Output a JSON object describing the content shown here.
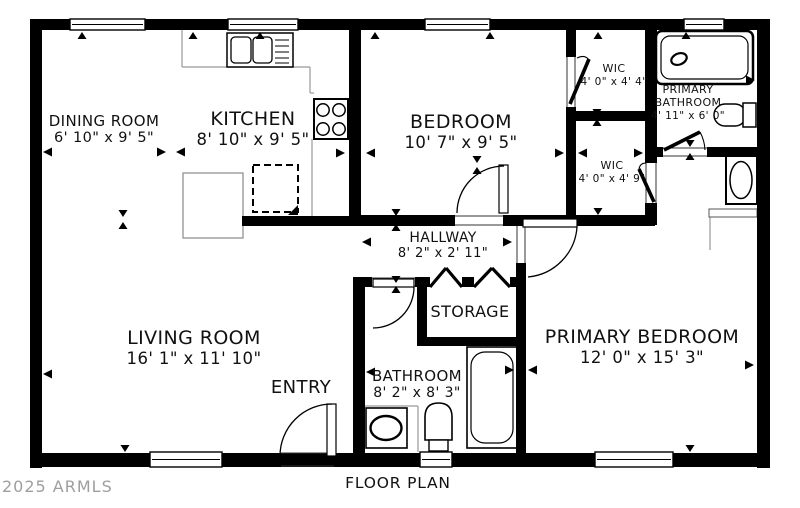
{
  "caption": "FLOOR PLAN",
  "watermark": "2025 ARMLS",
  "colors": {
    "wall": "#000000",
    "counter": "#999999",
    "jamb": "#333333",
    "text": "#111111",
    "watermark": "#9e9e9e",
    "bg": "#ffffff"
  },
  "rooms": [
    {
      "n": "dining-room",
      "lines": [
        "DINING ROOM",
        "6' 10\" x 9' 5\""
      ],
      "x": 104,
      "y": 113,
      "fs": [
        15,
        14.5
      ]
    },
    {
      "n": "kitchen",
      "lines": [
        "KITCHEN",
        "8' 10\" x 9' 5\""
      ],
      "x": 253,
      "y": 108,
      "fs": [
        19,
        16.5
      ]
    },
    {
      "n": "bedroom",
      "lines": [
        "BEDROOM",
        "10' 7\" x 9' 5\""
      ],
      "x": 461,
      "y": 111,
      "fs": [
        19,
        16.5
      ]
    },
    {
      "n": "wic-top",
      "lines": [
        "WIC",
        "4' 0\" x 4' 4\""
      ],
      "x": 614,
      "y": 63,
      "fs": [
        11,
        10.5
      ]
    },
    {
      "n": "primary-bathroom",
      "lines": [
        "PRIMARY",
        "BATHROOM",
        "4' 11\" x 6' 0\""
      ],
      "x": 688,
      "y": 84,
      "fs": [
        11,
        11,
        10.5
      ]
    },
    {
      "n": "wic-bottom",
      "lines": [
        "WIC",
        "4' 0\" x 4' 9\""
      ],
      "x": 612,
      "y": 160,
      "fs": [
        11,
        10.5
      ]
    },
    {
      "n": "hallway",
      "lines": [
        "HALLWAY",
        "8' 2\" x 2' 11\""
      ],
      "x": 443,
      "y": 230,
      "fs": [
        14,
        13
      ]
    },
    {
      "n": "storage",
      "lines": [
        "STORAGE"
      ],
      "x": 470,
      "y": 303,
      "fs": [
        16
      ]
    },
    {
      "n": "living-room",
      "lines": [
        "LIVING ROOM",
        "16' 1\" x 11' 10\""
      ],
      "x": 194,
      "y": 327,
      "fs": [
        19,
        16.5
      ]
    },
    {
      "n": "entry",
      "lines": [
        "ENTRY"
      ],
      "x": 301,
      "y": 378,
      "fs": [
        18
      ]
    },
    {
      "n": "bathroom",
      "lines": [
        "BATHROOM",
        "8' 2\" x 8' 3\""
      ],
      "x": 417,
      "y": 368,
      "fs": [
        15,
        14
      ]
    },
    {
      "n": "primary-bedroom",
      "lines": [
        "PRIMARY BEDROOM",
        "12' 0\" x 15' 3\""
      ],
      "x": 642,
      "y": 326,
      "fs": [
        19,
        16.5
      ]
    }
  ],
  "caption_pos": {
    "x": 398,
    "y": 474
  },
  "watermark_pos": {
    "x": 2,
    "y": 477
  },
  "plan": {
    "walls": [
      [
        30,
        19,
        740,
        11
      ],
      [
        30,
        19,
        12,
        449
      ],
      [
        30,
        453,
        740,
        14
      ],
      [
        757,
        19,
        13,
        449
      ],
      [
        349,
        30,
        12,
        196
      ],
      [
        242,
        216,
        119,
        10
      ],
      [
        361,
        215,
        94,
        11
      ],
      [
        503,
        215,
        152,
        11
      ],
      [
        566,
        30,
        10,
        27
      ],
      [
        566,
        107,
        10,
        108
      ],
      [
        566,
        111,
        91,
        10
      ],
      [
        645,
        30,
        12,
        133
      ],
      [
        645,
        203,
        12,
        22
      ],
      [
        645,
        147,
        18,
        10
      ],
      [
        707,
        147,
        63,
        10
      ],
      [
        353,
        277,
        19,
        10
      ],
      [
        415,
        277,
        15,
        10
      ],
      [
        462,
        277,
        12,
        10
      ],
      [
        510,
        277,
        16,
        10
      ],
      [
        353,
        277,
        12,
        190
      ],
      [
        417,
        287,
        10,
        59
      ],
      [
        417,
        337,
        109,
        9
      ],
      [
        516,
        287,
        10,
        50
      ],
      [
        516,
        263,
        10,
        24
      ],
      [
        516,
        346,
        10,
        107
      ]
    ],
    "windows": [
      [
        70,
        19,
        75,
        11
      ],
      [
        228,
        19,
        70,
        11
      ],
      [
        425,
        19,
        65,
        11
      ],
      [
        684,
        19,
        40,
        11
      ],
      [
        150,
        452,
        72,
        15
      ],
      [
        420,
        452,
        32,
        15
      ],
      [
        595,
        452,
        78,
        15
      ]
    ],
    "jambs": [
      [
        455,
        216,
        503,
        216
      ],
      [
        455,
        225,
        503,
        225
      ],
      [
        517,
        226,
        517,
        263
      ],
      [
        525,
        226,
        525,
        263
      ],
      [
        372,
        278,
        415,
        278
      ],
      [
        372,
        286,
        415,
        286
      ],
      [
        663,
        148,
        707,
        148
      ],
      [
        663,
        156,
        707,
        156
      ],
      [
        567,
        57,
        567,
        107
      ],
      [
        575,
        57,
        575,
        107
      ],
      [
        646,
        163,
        646,
        203
      ],
      [
        656,
        163,
        656,
        203
      ],
      [
        281,
        453,
        334,
        453
      ],
      [
        281,
        466,
        334,
        466
      ]
    ],
    "counters": [
      [
        182,
        30,
        182,
        67
      ],
      [
        182,
        67,
        310,
        67
      ],
      [
        310,
        67,
        310,
        93
      ],
      [
        310,
        93,
        314,
        93
      ],
      [
        312,
        139,
        312,
        216
      ],
      [
        365,
        406,
        418,
        406
      ],
      [
        418,
        406,
        418,
        452
      ],
      [
        710,
        217,
        710,
        250
      ]
    ],
    "doors": {
      "leaves": [
        [
          499,
          165,
          9,
          48
        ],
        [
          327,
          404,
          9,
          52
        ],
        [
          523,
          219,
          54,
          8
        ],
        [
          373,
          279,
          41,
          8
        ]
      ],
      "arcs": [
        "M457,213 A47,47 0 0 1 504,166",
        "M280,456 A52,52 0 0 1 332,404",
        "M577,227 A54,54 0 0 1 528,277",
        "M414,287 A41,41 0 0 1 373,328"
      ],
      "diagonals": [
        [
          570,
          104,
          589,
          59
        ],
        [
          639,
          169,
          654,
          202
        ],
        [
          664,
          150,
          700,
          132
        ]
      ],
      "small_arcs": [
        "M577,58 Q585,54 589,60",
        "M639,169 Q640,163 646,163",
        "M700,132 A42,42 0 0 1 705,150"
      ]
    },
    "bifold": [
      [
        430,
        287,
        446,
        268
      ],
      [
        446,
        268,
        462,
        287
      ],
      [
        474,
        287,
        492,
        268
      ],
      [
        492,
        268,
        510,
        287
      ]
    ],
    "arrows": [
      [
        "l",
        43,
        152
      ],
      [
        "r",
        166,
        152
      ],
      [
        "l",
        176,
        152
      ],
      [
        "r",
        345,
        153
      ],
      [
        "l",
        366,
        153
      ],
      [
        "r",
        564,
        153
      ],
      [
        "l",
        578,
        153
      ],
      [
        "r",
        643,
        153
      ],
      [
        "r",
        755,
        80
      ],
      [
        "l",
        43,
        374
      ],
      [
        "l",
        366,
        372
      ],
      [
        "r",
        514,
        370
      ],
      [
        "l",
        528,
        370
      ],
      [
        "r",
        754,
        365
      ],
      [
        "l",
        362,
        242
      ],
      [
        "r",
        512,
        242
      ],
      [
        "u",
        82,
        32
      ],
      [
        "u",
        193,
        32
      ],
      [
        "u",
        260,
        32
      ],
      [
        "u",
        375,
        32
      ],
      [
        "u",
        490,
        32
      ],
      [
        "u",
        598,
        32
      ],
      [
        "u",
        686,
        32
      ],
      [
        "d",
        123,
        217
      ],
      [
        "u",
        123,
        222
      ],
      [
        "d",
        396,
        216
      ],
      [
        "u",
        396,
        224
      ],
      [
        "d",
        396,
        283
      ],
      [
        "u",
        396,
        286
      ],
      [
        "d",
        597,
        116
      ],
      [
        "u",
        597,
        119
      ],
      [
        "d",
        598,
        215
      ],
      [
        "d",
        477,
        163
      ],
      [
        "u",
        477,
        167
      ],
      [
        "d",
        690,
        147
      ],
      [
        "u",
        690,
        153
      ],
      [
        "d",
        690,
        452
      ],
      [
        "d",
        125,
        452
      ]
    ],
    "fixtures": [
      {
        "n": "kitchen-island",
        "shapes": [
          {
            "t": "rect",
            "a": {
              "x": 183,
              "y": 173,
              "width": 60,
              "height": 65,
              "fill": "#fff",
              "stroke": "#888",
              "stroke-width": 1.2
            }
          }
        ]
      },
      {
        "n": "dishwasher",
        "shapes": [
          {
            "t": "rect",
            "a": {
              "x": 253,
              "y": 165,
              "width": 45,
              "height": 47,
              "fill": "none",
              "stroke": "#000",
              "stroke-width": 2,
              "stroke-dasharray": "7 4"
            }
          },
          {
            "t": "path",
            "a": {
              "d": "M298,205 L298,215 L288,215 Z",
              "fill": "#000"
            }
          }
        ]
      },
      {
        "n": "kitchen-sink",
        "shapes": [
          {
            "t": "rect",
            "a": {
              "x": 227,
              "y": 33,
              "width": 66,
              "height": 34,
              "fill": "#fff",
              "stroke": "#000",
              "stroke-width": 1.5
            }
          },
          {
            "t": "rect",
            "a": {
              "x": 231,
              "y": 37,
              "width": 20,
              "height": 26,
              "rx": 4,
              "fill": "none",
              "stroke": "#000",
              "stroke-width": 1.3
            }
          },
          {
            "t": "rect",
            "a": {
              "x": 253,
              "y": 37,
              "width": 19,
              "height": 26,
              "rx": 4,
              "fill": "none",
              "stroke": "#000",
              "stroke-width": 1.3
            }
          },
          {
            "t": "line",
            "a": {
              "x1": 275,
              "y1": 40,
              "x2": 289,
              "y2": 40,
              "stroke": "#000",
              "stroke-width": 1
            }
          },
          {
            "t": "line",
            "a": {
              "x1": 275,
              "y1": 46,
              "x2": 289,
              "y2": 46,
              "stroke": "#000",
              "stroke-width": 1
            }
          },
          {
            "t": "line",
            "a": {
              "x1": 275,
              "y1": 52,
              "x2": 289,
              "y2": 52,
              "stroke": "#000",
              "stroke-width": 1
            }
          },
          {
            "t": "line",
            "a": {
              "x1": 275,
              "y1": 58,
              "x2": 289,
              "y2": 58,
              "stroke": "#000",
              "stroke-width": 1
            }
          },
          {
            "t": "line",
            "a": {
              "x1": 275,
              "y1": 63,
              "x2": 289,
              "y2": 63,
              "stroke": "#000",
              "stroke-width": 1
            }
          }
        ]
      },
      {
        "n": "stove",
        "shapes": [
          {
            "t": "rect",
            "a": {
              "x": 314,
              "y": 99,
              "width": 34,
              "height": 40,
              "fill": "#fff",
              "stroke": "#000",
              "stroke-width": 2
            }
          },
          {
            "t": "circle",
            "a": {
              "cx": 323,
              "cy": 110,
              "r": 6.2,
              "fill": "none",
              "stroke": "#000",
              "stroke-width": 1.5
            }
          },
          {
            "t": "circle",
            "a": {
              "cx": 339,
              "cy": 110,
              "r": 6.2,
              "fill": "none",
              "stroke": "#000",
              "stroke-width": 1.5
            }
          },
          {
            "t": "circle",
            "a": {
              "cx": 323,
              "cy": 129,
              "r": 6.2,
              "fill": "none",
              "stroke": "#000",
              "stroke-width": 1.5
            }
          },
          {
            "t": "circle",
            "a": {
              "cx": 339,
              "cy": 129,
              "r": 6.2,
              "fill": "none",
              "stroke": "#000",
              "stroke-width": 1.5
            }
          }
        ]
      },
      {
        "n": "shower",
        "shapes": [
          {
            "t": "rect",
            "a": {
              "x": 656,
              "y": 31,
              "width": 97,
              "height": 53,
              "rx": 6,
              "fill": "#fff",
              "stroke": "#000",
              "stroke-width": 2.5
            }
          },
          {
            "t": "rect",
            "a": {
              "x": 661,
              "y": 36,
              "width": 87,
              "height": 43,
              "rx": 9,
              "fill": "none",
              "stroke": "#000",
              "stroke-width": 1.2
            }
          },
          {
            "t": "ellipse",
            "a": {
              "cx": 679,
              "cy": 59,
              "rx": 8,
              "ry": 5.5,
              "fill": "none",
              "stroke": "#000",
              "stroke-width": 2.2,
              "transform": "rotate(-22 679 59)"
            }
          }
        ]
      },
      {
        "n": "primary-toilet",
        "shapes": [
          {
            "t": "rect",
            "a": {
              "x": 714,
              "y": 104,
              "width": 32,
              "height": 22,
              "rx": 11,
              "fill": "#fff",
              "stroke": "#000",
              "stroke-width": 1.5
            }
          },
          {
            "t": "rect",
            "a": {
              "x": 743,
              "y": 103,
              "width": 13,
              "height": 24,
              "fill": "#fff",
              "stroke": "#000",
              "stroke-width": 1.5
            }
          }
        ]
      },
      {
        "n": "washer",
        "shapes": [
          {
            "t": "rect",
            "a": {
              "x": 726,
              "y": 156,
              "width": 31,
              "height": 48,
              "fill": "#fff",
              "stroke": "#000",
              "stroke-width": 2
            }
          },
          {
            "t": "ellipse",
            "a": {
              "cx": 741,
              "cy": 180,
              "rx": 11,
              "ry": 18.5,
              "fill": "none",
              "stroke": "#000",
              "stroke-width": 1.5
            }
          },
          {
            "t": "rect",
            "a": {
              "x": 709,
              "y": 209,
              "width": 48,
              "height": 8,
              "fill": "#fff",
              "stroke": "#555",
              "stroke-width": 1
            }
          }
        ]
      },
      {
        "n": "bathtub",
        "shapes": [
          {
            "t": "rect",
            "a": {
              "x": 467,
              "y": 347,
              "width": 50,
              "height": 101,
              "fill": "#fff",
              "stroke": "#000",
              "stroke-width": 1.6
            }
          },
          {
            "t": "rect",
            "a": {
              "x": 471,
              "y": 352,
              "width": 42,
              "height": 91,
              "rx": 14,
              "fill": "none",
              "stroke": "#000",
              "stroke-width": 1.2
            }
          }
        ]
      },
      {
        "n": "bathroom-sink",
        "shapes": [
          {
            "t": "rect",
            "a": {
              "x": 366,
              "y": 408,
              "width": 41,
              "height": 40,
              "fill": "#fff",
              "stroke": "#000",
              "stroke-width": 1.6
            }
          },
          {
            "t": "ellipse",
            "a": {
              "cx": 386,
              "cy": 428,
              "rx": 15.5,
              "ry": 12,
              "fill": "none",
              "stroke": "#000",
              "stroke-width": 2.4
            }
          }
        ]
      },
      {
        "n": "bathroom-toilet",
        "shapes": [
          {
            "t": "path",
            "a": {
              "d": "M425,440 L425,417 Q425,403 438.5,403 Q452,403 452,417 L452,440 Z",
              "fill": "#fff",
              "stroke": "#000",
              "stroke-width": 1.6
            }
          },
          {
            "t": "rect",
            "a": {
              "x": 429,
              "y": 440,
              "width": 19,
              "height": 11,
              "fill": "#fff",
              "stroke": "#000",
              "stroke-width": 1.4
            }
          }
        ]
      }
    ]
  }
}
